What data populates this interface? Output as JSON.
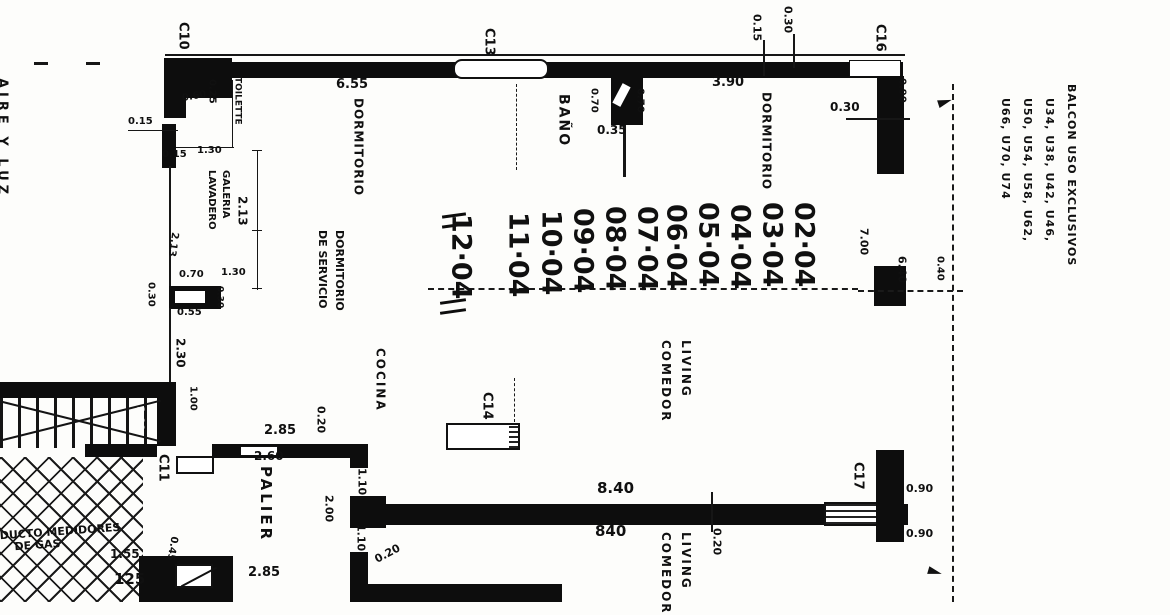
{
  "rooms": {
    "dormitorio_left": "DORMITORIO",
    "dormitorio_right": "DORMITORIO",
    "bano": "BAÑO",
    "toilette": "TOILETTE",
    "galeria_l1": "GALERIA",
    "galeria_l2": "LAVADERO",
    "dorm_serv_l1": "DORMITORIO",
    "dorm_serv_l2": "DE SERVICIO",
    "cocina": "COCINA",
    "living_l1": "LIVING",
    "living_l2": "COMEDOR",
    "living2_l1": "LIVING",
    "living2_l2": "COMEDOR",
    "palier": "PALIER",
    "ducto_l1": "DUCTO MEDIDORES",
    "ducto_l2": "DE GAS",
    "aire_luz": "AIRE Y LUZ"
  },
  "unit_numbers": [
    "02·04",
    "03·04",
    "04·04",
    "05·04",
    "06·04",
    "07·04",
    "08·04",
    "09·04",
    "10·04",
    "11·04",
    "12·04"
  ],
  "column_refs": {
    "c10": "C10",
    "c11": "C11",
    "c13": "C13",
    "c14": "C14",
    "c16": "C16",
    "c17": "C17"
  },
  "balcony_note": {
    "line1": "BALCON USO EXCLUSIVOS",
    "line2": "U34, U38, U42, U46,",
    "line3": "U50, U54, U58, U62,",
    "line4": "U66, U70, U74"
  },
  "dims": {
    "top_655": "6.55",
    "top_390": "3.90",
    "top_015": "0.15",
    "top_030": "0.30",
    "tr_090": "0.90",
    "tr_030": "0.30",
    "toilette_025": "0.25",
    "toilette_060": "0.60",
    "left_015a": "0.15",
    "left_130": "1.30",
    "left_015b": "0.15",
    "gal_213a": "2.13",
    "gal_213b": "2.13",
    "gal_070": "0.70",
    "gal_130": "1.30",
    "duct_030l": "0.30",
    "duct_055": "0.55",
    "duct_030r": "0.30",
    "left_230": "2.30",
    "left_100": "1.00",
    "stair_100": "1.00",
    "bano_070l": "0.70",
    "bano_070r": "0.70",
    "bano_035": "0.35",
    "right_700": "7.00",
    "right_640": "6.40",
    "right_040": "0.40",
    "palier_285t": "2.85",
    "palier_020t": "0.20",
    "palier_260": "2.60",
    "palier_110a": "1.10",
    "palier_200": "2.00",
    "palier_110b": "1.10",
    "palier_020b": "0.20",
    "palier_285b": "2.85",
    "stair_155": "1.55",
    "stair_125": "125",
    "stair_045": "0.45",
    "bottom_840a": "8.40",
    "bottom_840b": "840",
    "bottom_020": "0.20",
    "c17_090a": "0.90",
    "c17_090b": "0.90"
  }
}
